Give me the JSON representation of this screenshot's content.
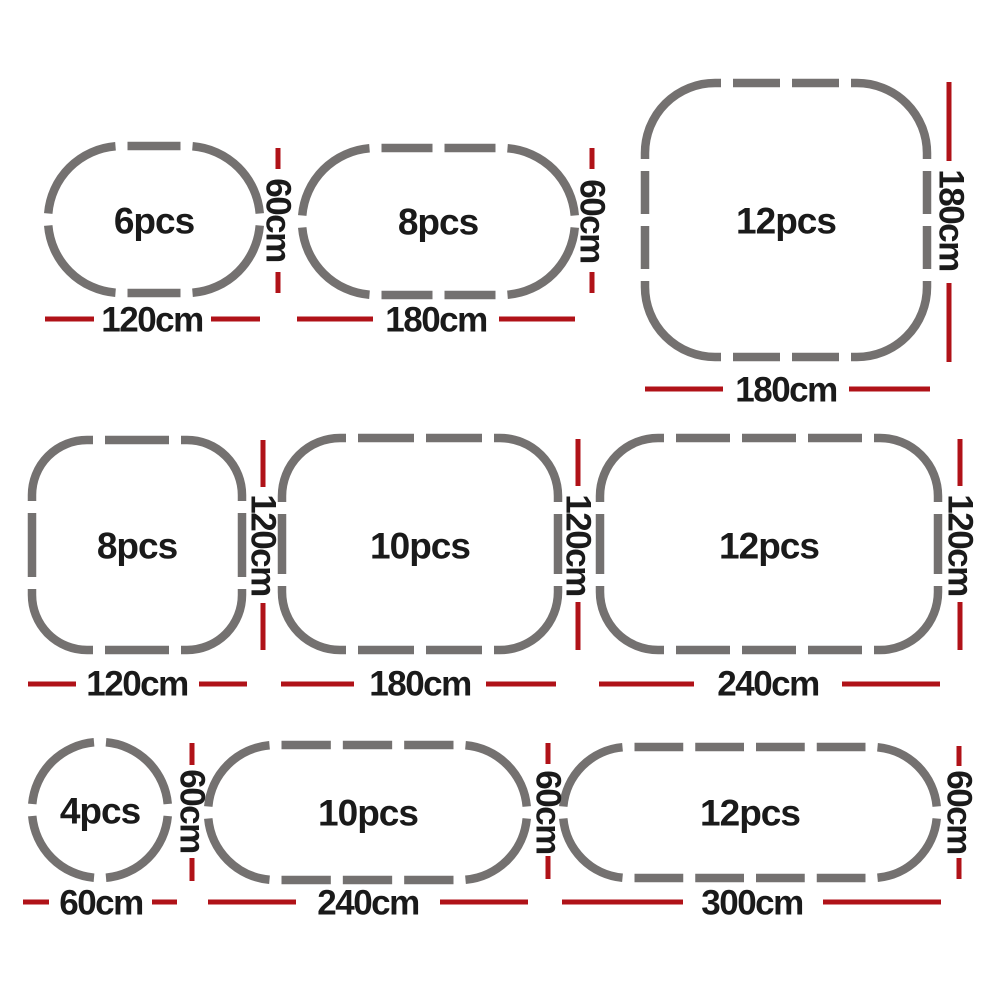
{
  "diagram_title": "Playpen panel configurations",
  "unit": "cm",
  "colors": {
    "panel_gray": "#747170",
    "dimension_red": "#b01218",
    "text_black": "#1a1a1a",
    "background": "#ffffff"
  },
  "configurations": [
    {
      "id": "config-1",
      "shape": "oval",
      "pieces": 6,
      "pieces_label": "6pcs",
      "width_label": "120cm",
      "height_label": "60cm"
    },
    {
      "id": "config-2",
      "shape": "oval",
      "pieces": 8,
      "pieces_label": "8pcs",
      "width_label": "180cm",
      "height_label": "60cm"
    },
    {
      "id": "config-3",
      "shape": "rounded-square",
      "pieces": 12,
      "pieces_label": "12pcs",
      "width_label": "180cm",
      "height_label": "180cm"
    },
    {
      "id": "config-4",
      "shape": "rounded-square",
      "pieces": 8,
      "pieces_label": "8pcs",
      "width_label": "120cm",
      "height_label": "120cm"
    },
    {
      "id": "config-5",
      "shape": "rounded-rectangle",
      "pieces": 10,
      "pieces_label": "10pcs",
      "width_label": "180cm",
      "height_label": "120cm"
    },
    {
      "id": "config-6",
      "shape": "rounded-rectangle",
      "pieces": 12,
      "pieces_label": "12pcs",
      "width_label": "240cm",
      "height_label": "120cm"
    },
    {
      "id": "config-7",
      "shape": "circle",
      "pieces": 4,
      "pieces_label": "4pcs",
      "width_label": "60cm",
      "height_label": "60cm"
    },
    {
      "id": "config-8",
      "shape": "oval",
      "pieces": 10,
      "pieces_label": "10pcs",
      "width_label": "240cm",
      "height_label": "60cm"
    },
    {
      "id": "config-9",
      "shape": "oval",
      "pieces": 12,
      "pieces_label": "12pcs",
      "width_label": "300cm",
      "height_label": "60cm"
    }
  ]
}
